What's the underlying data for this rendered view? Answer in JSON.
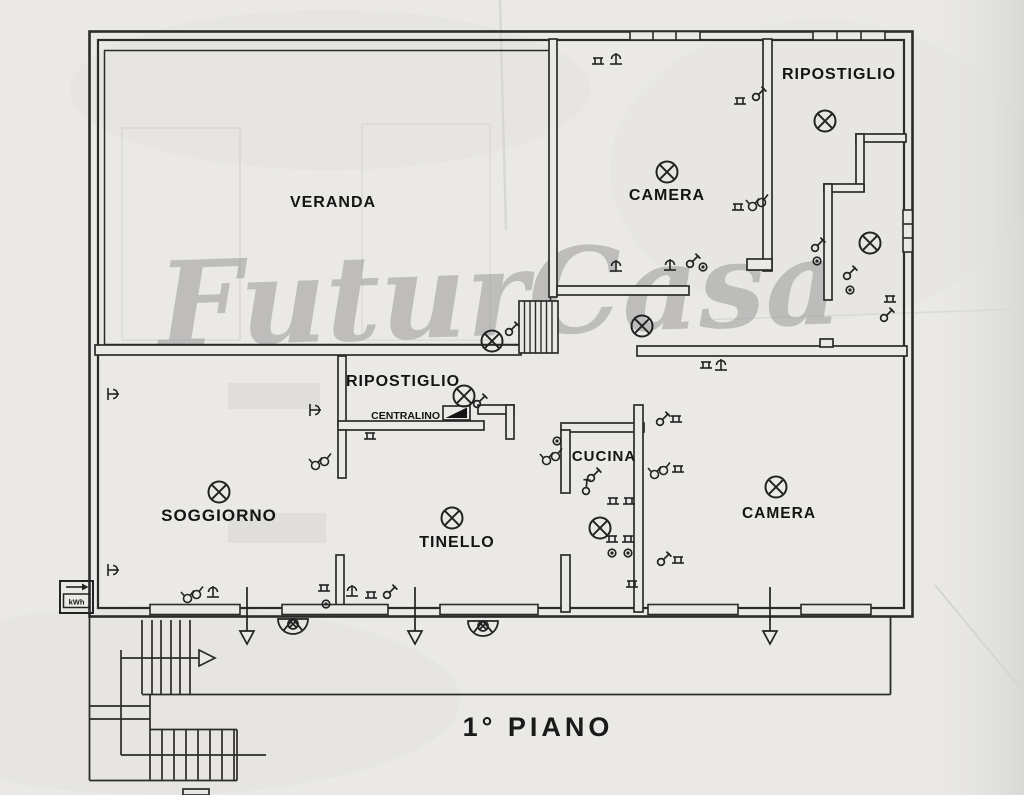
{
  "title": {
    "text": "1°  PIANO"
  },
  "watermark": {
    "text": "FuturCasa",
    "color": "#8f8f8f"
  },
  "rooms": {
    "veranda": {
      "label": "VERANDA"
    },
    "camera_top": {
      "label": "CAMERA"
    },
    "ripostiglio_top": {
      "label": "RIPOSTIGLIO"
    },
    "ripostiglio_center": {
      "label": "RIPOSTIGLIO"
    },
    "soggiorno": {
      "label": "SOGGIORNO"
    },
    "tinello": {
      "label": "TINELLO"
    },
    "cucina": {
      "label": "CUCINA"
    },
    "camera_bottom": {
      "label": "CAMERA"
    }
  },
  "annotations": {
    "centralino": "CENTRALINO",
    "meter": "kWh"
  },
  "symbols_legend": {
    "ceiling_light": "circle-cross-ceiling-light",
    "wall_light": "half-round-wall-lamp",
    "switch": "light-switch",
    "socket": "power-socket",
    "button": "push-button",
    "dimmer": "double-circle-switch-group",
    "exit_arrow": "door-exit-arrow",
    "stairs_arrow": "stairs-direction-arrow"
  },
  "colors": {
    "ink": "#262626",
    "paper": "#eae9e6",
    "watermark": "#8f8f8f"
  }
}
